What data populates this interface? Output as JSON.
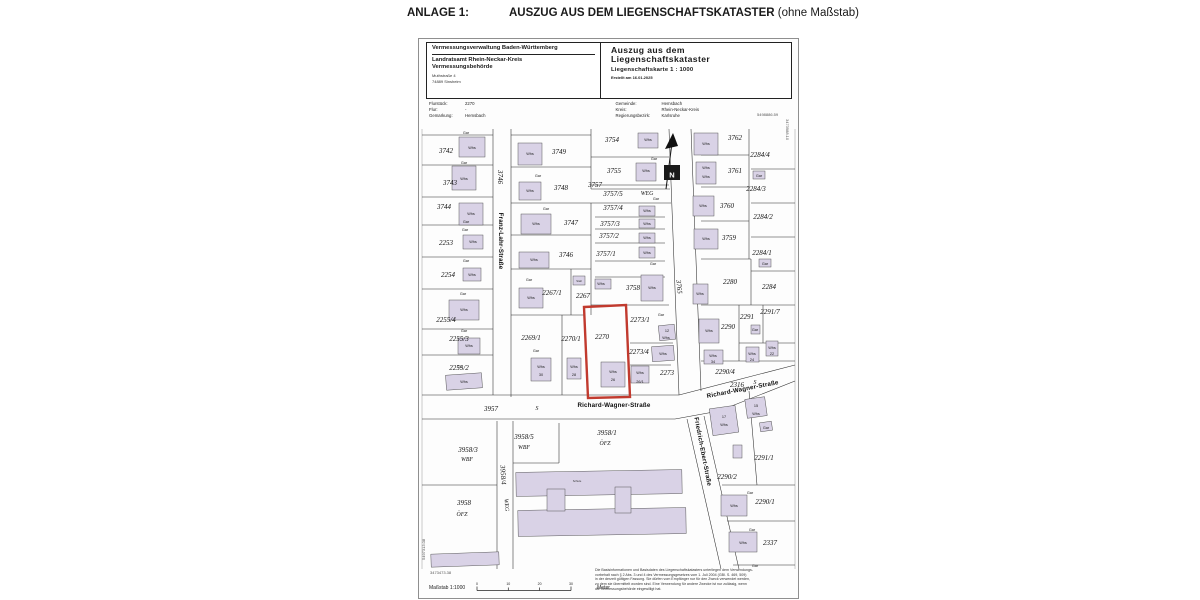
{
  "page": {
    "anlage_label": "ANLAGE 1:",
    "title": "AUSZUG AUS DEM LIEGENSCHAFTSKATASTER",
    "title_suffix": "(ohne Maßstab)"
  },
  "header": {
    "authority": "Vermessungsverwaltung Baden-Württemberg",
    "office_line1": "Landratsamt Rhein-Neckar-Kreis",
    "office_line2": "Vermessungsbehörde",
    "address_line1": "Muthstraße 4",
    "address_line2": "74889 Sinsheim",
    "doc_title_line1": "Auszug aus dem",
    "doc_title_line2": "Liegenschaftskataster",
    "doc_subtitle": "Liegenschaftskarte 1 : 1000",
    "created": "Erstellt am 16.01.2025"
  },
  "meta": {
    "flurstueck_label": "Flurstück:",
    "flurstueck": "2270",
    "flur_label": "Flur:",
    "flur": "-",
    "gemarkung_label": "Gemarkung:",
    "gemarkung": "Hemsbach",
    "gemeinde_label": "Gemeinde:",
    "gemeinde": "Hemsbach",
    "kreis_label": "Kreis:",
    "kreis": "Rhein-Neckar-Kreis",
    "regbez_label": "Regierungsbezirk:",
    "regbez": "Karlsruhe"
  },
  "corners": {
    "top_right_h": "5498886.59",
    "top_right_v": "3473988.10",
    "bottom_left_h": "3473473.38",
    "bottom_left_v": "5497313.08"
  },
  "footer": {
    "massstab_label": "Maßstab 1:1000",
    "scale_ticks": [
      "0",
      "10",
      "20",
      "30"
    ],
    "scale_unit": "Meter",
    "disclaimer_lines": [
      "Die Basisinformationen und Basisdaten des Liegenschaftskatasters unterliegen dem Verwendungs-",
      "vorbehalt nach § 2 Abs. 3 und 4 des Vermessungsgesetzes vom 1. Juli 2004 (GBl. S. 469, 509)",
      "in der derzeit gültigen Fassung. Sie dürfen vom Empfänger nur für den Zweck verwendet werden,",
      "zu dem sie übermittelt worden sind. Eine Verwendung für andere Zwecke ist nur zulässig, wenn",
      "die Vermessungsbehörde eingewilligt hat."
    ]
  },
  "colors": {
    "highlight": "#c13a2e",
    "building": "#d9d2e6"
  },
  "map": {
    "red_parcel": {
      "number": "2270",
      "points": "165,178 207,176 211,268 169,269"
    },
    "buildings": [
      [
        40,
        8,
        26,
        20
      ],
      [
        33,
        37,
        24,
        24
      ],
      [
        40,
        74,
        24,
        22
      ],
      [
        44,
        106,
        20,
        14
      ],
      [
        44,
        139,
        18,
        13
      ],
      [
        30,
        171,
        30,
        20
      ],
      [
        39,
        209,
        22,
        16
      ],
      [
        27,
        245,
        36,
        15,
        -4
      ],
      [
        99,
        14,
        24,
        22
      ],
      [
        100,
        53,
        22,
        18
      ],
      [
        102,
        85,
        30,
        20
      ],
      [
        100,
        123,
        30,
        16
      ],
      [
        100,
        159,
        24,
        20
      ],
      [
        154,
        147,
        12,
        9
      ],
      [
        176,
        150,
        16,
        10
      ],
      [
        112,
        229,
        20,
        23
      ],
      [
        148,
        229,
        14,
        21
      ],
      [
        182,
        233,
        24,
        25
      ],
      [
        212,
        237,
        18,
        17
      ],
      [
        219,
        4,
        20,
        15
      ],
      [
        217,
        34,
        20,
        18
      ],
      [
        220,
        77,
        16,
        10
      ],
      [
        220,
        90,
        16,
        9
      ],
      [
        220,
        104,
        16,
        10
      ],
      [
        220,
        118,
        16,
        11
      ],
      [
        222,
        146,
        22,
        26
      ],
      [
        275,
        4,
        24,
        22
      ],
      [
        277,
        33,
        20,
        22
      ],
      [
        274,
        67,
        21,
        20
      ],
      [
        275,
        100,
        24,
        20
      ],
      [
        334,
        42,
        12,
        8
      ],
      [
        340,
        130,
        12,
        8
      ],
      [
        274,
        155,
        15,
        20
      ],
      [
        280,
        190,
        20,
        24
      ],
      [
        285,
        221,
        19,
        14
      ],
      [
        327,
        218,
        13,
        15
      ],
      [
        347,
        212,
        12,
        15
      ],
      [
        332,
        196,
        9,
        9
      ],
      [
        240,
        196,
        16,
        15,
        -6
      ],
      [
        233,
        217,
        22,
        15,
        -4
      ],
      [
        292,
        278,
        26,
        27,
        -8
      ],
      [
        327,
        269,
        20,
        19,
        -8
      ],
      [
        341,
        293,
        12,
        9,
        -8
      ],
      [
        314,
        316,
        9,
        13
      ],
      [
        302,
        366,
        26,
        21
      ],
      [
        310,
        403,
        28,
        20
      ],
      [
        97,
        342,
        166,
        24,
        -1
      ],
      [
        99,
        380,
        168,
        26,
        -1
      ],
      [
        128,
        360,
        18,
        22
      ],
      [
        196,
        358,
        16,
        26
      ],
      [
        12,
        424,
        68,
        13,
        -2
      ]
    ],
    "labels": [
      {
        "t": "3742",
        "x": 27,
        "y": 24
      },
      {
        "t": "3743",
        "x": 31,
        "y": 56
      },
      {
        "t": "3744",
        "x": 25,
        "y": 80
      },
      {
        "t": "2253",
        "x": 27,
        "y": 116
      },
      {
        "t": "2254",
        "x": 29,
        "y": 148
      },
      {
        "t": "2255/4",
        "x": 27,
        "y": 193
      },
      {
        "t": "2255/3",
        "x": 40,
        "y": 212
      },
      {
        "t": "2255/2",
        "x": 40,
        "y": 241
      },
      {
        "t": "3746",
        "x": 79,
        "y": 48,
        "r": 90
      },
      {
        "t": "Franz-Lahr-Straße",
        "x": 80,
        "y": 112,
        "cls": "st",
        "r": 90
      },
      {
        "t": "3749",
        "x": 140,
        "y": 25
      },
      {
        "t": "3748",
        "x": 142,
        "y": 61
      },
      {
        "t": "3747",
        "x": 152,
        "y": 96
      },
      {
        "t": "3746",
        "x": 147,
        "y": 128
      },
      {
        "t": "2267/1",
        "x": 133,
        "y": 166
      },
      {
        "t": "2267",
        "x": 164,
        "y": 169
      },
      {
        "t": "2269/1",
        "x": 112,
        "y": 211
      },
      {
        "t": "2270/1",
        "x": 152,
        "y": 212
      },
      {
        "t": "2270",
        "x": 183,
        "y": 210
      },
      {
        "t": "3754",
        "x": 193,
        "y": 13
      },
      {
        "t": "3755",
        "x": 195,
        "y": 44
      },
      {
        "t": "3757",
        "x": 176,
        "y": 58
      },
      {
        "t": "3757/5",
        "x": 194,
        "y": 67
      },
      {
        "t": "WEG",
        "x": 228,
        "y": 66,
        "cls": "z"
      },
      {
        "t": "3757/4",
        "x": 194,
        "y": 81
      },
      {
        "t": "3757/3",
        "x": 191,
        "y": 97
      },
      {
        "t": "3757/2",
        "x": 190,
        "y": 109
      },
      {
        "t": "3757/1",
        "x": 187,
        "y": 127
      },
      {
        "t": "3758",
        "x": 214,
        "y": 161
      },
      {
        "t": "3765",
        "x": 258,
        "y": 158,
        "r": 84
      },
      {
        "t": "3762",
        "x": 316,
        "y": 11
      },
      {
        "t": "2284/4",
        "x": 341,
        "y": 28
      },
      {
        "t": "3761",
        "x": 316,
        "y": 44
      },
      {
        "t": "2284/3",
        "x": 337,
        "y": 62
      },
      {
        "t": "3760",
        "x": 308,
        "y": 79
      },
      {
        "t": "2284/2",
        "x": 344,
        "y": 90
      },
      {
        "t": "3759",
        "x": 310,
        "y": 111
      },
      {
        "t": "2284/1",
        "x": 343,
        "y": 126
      },
      {
        "t": "2280",
        "x": 311,
        "y": 155
      },
      {
        "t": "2284",
        "x": 350,
        "y": 160
      },
      {
        "t": "2291/7",
        "x": 351,
        "y": 185
      },
      {
        "t": "2291",
        "x": 328,
        "y": 190
      },
      {
        "t": "2290",
        "x": 309,
        "y": 200
      },
      {
        "t": "2273/1",
        "x": 221,
        "y": 193
      },
      {
        "t": "2273/4",
        "x": 220,
        "y": 225
      },
      {
        "t": "2273",
        "x": 248,
        "y": 246
      },
      {
        "t": "2290/4",
        "x": 306,
        "y": 245
      },
      {
        "t": "2316",
        "x": 318,
        "y": 258
      },
      {
        "t": "S",
        "x": 336,
        "y": 255,
        "cls": "z"
      },
      {
        "t": "Richard-Wagner-Straße",
        "x": 324,
        "y": 262,
        "cls": "st",
        "r": -11
      },
      {
        "t": "Friedrich-Ebert-Straße",
        "x": 282,
        "y": 323,
        "cls": "st",
        "r": 79
      },
      {
        "t": "2291/1",
        "x": 345,
        "y": 331
      },
      {
        "t": "2290/2",
        "x": 308,
        "y": 350
      },
      {
        "t": "2290/1",
        "x": 346,
        "y": 375
      },
      {
        "t": "2337",
        "x": 351,
        "y": 416
      },
      {
        "t": "Richard-Wagner-Straße",
        "x": 195,
        "y": 278,
        "cls": "st"
      },
      {
        "t": "S",
        "x": 118,
        "y": 281,
        "cls": "z"
      },
      {
        "t": "3957",
        "x": 72,
        "y": 282
      },
      {
        "t": "3958/3",
        "x": 49,
        "y": 323
      },
      {
        "t": "WBF",
        "x": 48,
        "y": 332,
        "cls": "z"
      },
      {
        "t": "3958/5",
        "x": 105,
        "y": 310
      },
      {
        "t": "WBF",
        "x": 105,
        "y": 320,
        "cls": "z"
      },
      {
        "t": "3958/1",
        "x": 188,
        "y": 306
      },
      {
        "t": "ÖFZ",
        "x": 186,
        "y": 316,
        "cls": "z"
      },
      {
        "t": "3958",
        "x": 45,
        "y": 376
      },
      {
        "t": "ÖFZ",
        "x": 43,
        "y": 387,
        "cls": "z"
      },
      {
        "t": "3958/4",
        "x": 82,
        "y": 346,
        "r": 86
      },
      {
        "t": "WEG",
        "x": 86,
        "y": 376,
        "cls": "z",
        "r": 86
      },
      {
        "t": "Schule",
        "x": 158,
        "y": 353,
        "cls": "t"
      },
      {
        "t": "Stall",
        "x": 160,
        "y": 153,
        "cls": "t"
      },
      {
        "t": "N",
        "x": 253,
        "y": 48.5,
        "cls": "n"
      },
      {
        "t": "Whs",
        "x": 53,
        "y": 20,
        "cls": "b"
      },
      {
        "t": "Gar",
        "x": 47,
        "y": 5,
        "cls": "b"
      },
      {
        "t": "Whs",
        "x": 45,
        "y": 51,
        "cls": "b"
      },
      {
        "t": "Gar",
        "x": 45,
        "y": 35,
        "cls": "b"
      },
      {
        "t": "Whs",
        "x": 52,
        "y": 86,
        "cls": "b"
      },
      {
        "t": "Gar",
        "x": 47,
        "y": 94,
        "cls": "b"
      },
      {
        "t": "Whs",
        "x": 54,
        "y": 114,
        "cls": "b"
      },
      {
        "t": "Gar",
        "x": 46,
        "y": 102,
        "cls": "b"
      },
      {
        "t": "Whs",
        "x": 53,
        "y": 147,
        "cls": "b"
      },
      {
        "t": "Gar",
        "x": 47,
        "y": 133,
        "cls": "b"
      },
      {
        "t": "Whs",
        "x": 45,
        "y": 182,
        "cls": "b"
      },
      {
        "t": "Gar",
        "x": 44,
        "y": 166,
        "cls": "b"
      },
      {
        "t": "Whs",
        "x": 50,
        "y": 218,
        "cls": "b"
      },
      {
        "t": "Gar",
        "x": 45,
        "y": 203,
        "cls": "b"
      },
      {
        "t": "Whs",
        "x": 45,
        "y": 254,
        "cls": "b"
      },
      {
        "t": "Gar",
        "x": 41,
        "y": 239,
        "cls": "b"
      },
      {
        "t": "Whs",
        "x": 111,
        "y": 26,
        "cls": "b"
      },
      {
        "t": "Whs",
        "x": 111,
        "y": 63,
        "cls": "b"
      },
      {
        "t": "Gar",
        "x": 119,
        "y": 48,
        "cls": "b"
      },
      {
        "t": "Whs",
        "x": 117,
        "y": 96,
        "cls": "b"
      },
      {
        "t": "Gar",
        "x": 127,
        "y": 81,
        "cls": "b"
      },
      {
        "t": "Whs",
        "x": 115,
        "y": 132,
        "cls": "b"
      },
      {
        "t": "Whs",
        "x": 112,
        "y": 170,
        "cls": "b"
      },
      {
        "t": "Gar",
        "x": 110,
        "y": 152,
        "cls": "b"
      },
      {
        "t": "Whs",
        "x": 182,
        "y": 156,
        "cls": "b"
      },
      {
        "t": "Whs",
        "x": 122,
        "y": 239,
        "cls": "b"
      },
      {
        "t": "30",
        "x": 122,
        "y": 247,
        "cls": "b"
      },
      {
        "t": "Gar",
        "x": 117,
        "y": 223,
        "cls": "b"
      },
      {
        "t": "Whs",
        "x": 155,
        "y": 239,
        "cls": "b"
      },
      {
        "t": "28",
        "x": 155,
        "y": 247,
        "cls": "b"
      },
      {
        "t": "Whs",
        "x": 194,
        "y": 244,
        "cls": "b"
      },
      {
        "t": "26",
        "x": 194,
        "y": 252,
        "cls": "b"
      },
      {
        "t": "Whs",
        "x": 221,
        "y": 245,
        "cls": "b"
      },
      {
        "t": "26/1",
        "x": 221,
        "y": 254,
        "cls": "b"
      },
      {
        "t": "Whs",
        "x": 229,
        "y": 12,
        "cls": "b"
      },
      {
        "t": "Whs",
        "x": 227,
        "y": 43,
        "cls": "b"
      },
      {
        "t": "Gar",
        "x": 235,
        "y": 31,
        "cls": "b"
      },
      {
        "t": "Whs",
        "x": 228,
        "y": 83,
        "cls": "b"
      },
      {
        "t": "Gar",
        "x": 237,
        "y": 71,
        "cls": "b"
      },
      {
        "t": "Whs",
        "x": 228,
        "y": 96,
        "cls": "b"
      },
      {
        "t": "Whs",
        "x": 228,
        "y": 110,
        "cls": "b"
      },
      {
        "t": "Whs",
        "x": 228,
        "y": 125,
        "cls": "b"
      },
      {
        "t": "Gar",
        "x": 234,
        "y": 136,
        "cls": "b"
      },
      {
        "t": "Whs",
        "x": 233,
        "y": 160,
        "cls": "b"
      },
      {
        "t": "Whs",
        "x": 287,
        "y": 16,
        "cls": "b"
      },
      {
        "t": "Whs",
        "x": 287,
        "y": 40,
        "cls": "b"
      },
      {
        "t": "Whs",
        "x": 287,
        "y": 49,
        "cls": "b"
      },
      {
        "t": "Whs",
        "x": 284,
        "y": 78,
        "cls": "b"
      },
      {
        "t": "Whs",
        "x": 287,
        "y": 111,
        "cls": "b"
      },
      {
        "t": "Gar",
        "x": 340,
        "y": 48,
        "cls": "b"
      },
      {
        "t": "Gar",
        "x": 346,
        "y": 136,
        "cls": "b"
      },
      {
        "t": "Whs",
        "x": 281,
        "y": 166,
        "cls": "b"
      },
      {
        "t": "Whs",
        "x": 290,
        "y": 203,
        "cls": "b"
      },
      {
        "t": "Whs",
        "x": 294,
        "y": 228,
        "cls": "b"
      },
      {
        "t": "34",
        "x": 294,
        "y": 234,
        "cls": "b"
      },
      {
        "t": "Whs",
        "x": 333,
        "y": 226,
        "cls": "b"
      },
      {
        "t": "24",
        "x": 333,
        "y": 232,
        "cls": "b"
      },
      {
        "t": "Whs",
        "x": 353,
        "y": 220,
        "cls": "b"
      },
      {
        "t": "22",
        "x": 353,
        "y": 226,
        "cls": "b"
      },
      {
        "t": "Gar",
        "x": 336,
        "y": 202,
        "cls": "b"
      },
      {
        "t": "12",
        "x": 248,
        "y": 203,
        "cls": "b"
      },
      {
        "t": "Whs",
        "x": 247,
        "y": 210,
        "cls": "b"
      },
      {
        "t": "Whs",
        "x": 244,
        "y": 226,
        "cls": "b"
      },
      {
        "t": "Gar",
        "x": 242,
        "y": 187,
        "cls": "b"
      },
      {
        "t": "17",
        "x": 305,
        "y": 289,
        "cls": "b"
      },
      {
        "t": "Whs",
        "x": 305,
        "y": 297,
        "cls": "b"
      },
      {
        "t": "15",
        "x": 337,
        "y": 278,
        "cls": "b"
      },
      {
        "t": "Whs",
        "x": 337,
        "y": 286,
        "cls": "b"
      },
      {
        "t": "Gar",
        "x": 347,
        "y": 300,
        "cls": "b"
      },
      {
        "t": "Whs",
        "x": 315,
        "y": 378,
        "cls": "b"
      },
      {
        "t": "Gar",
        "x": 331,
        "y": 365,
        "cls": "b"
      },
      {
        "t": "Whs",
        "x": 324,
        "y": 415,
        "cls": "b"
      },
      {
        "t": "Gar",
        "x": 333,
        "y": 402,
        "cls": "b"
      },
      {
        "t": "Gar",
        "x": 336,
        "y": 438,
        "cls": "b"
      }
    ]
  }
}
